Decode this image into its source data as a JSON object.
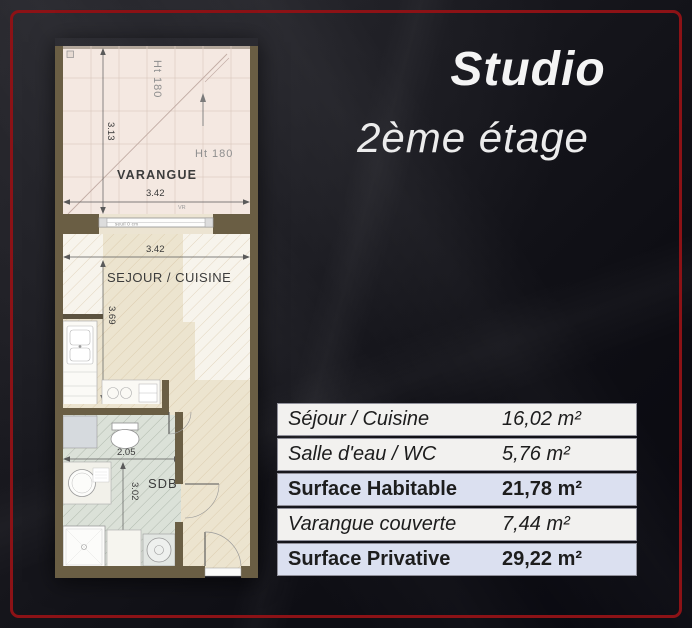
{
  "theme": {
    "frame_color": "#8c1216",
    "background_dark": "#0b0b10",
    "accent_row_color": "#dbe0f0",
    "wall_color": "#6a5e44"
  },
  "header": {
    "title": "Studio",
    "subtitle": "2ème étage"
  },
  "floor_plan": {
    "rooms": {
      "varangue": "VARANGUE",
      "sejour": "SEJOUR / CUISINE",
      "sdb": "SDB"
    },
    "dimensions": {
      "varangue_depth": "3.13",
      "varangue_width": "3.42",
      "sejour_width": "3.42",
      "sejour_depth": "3.69",
      "sdb_width": "2.05",
      "sdb_depth": "3.02"
    },
    "annotations": {
      "height_top": "Ht 180",
      "height_right": "Ht 180",
      "threshold": "seuil 0 cm",
      "shutter": "VR"
    }
  },
  "surface_table": {
    "rows": [
      {
        "label": "Séjour / Cuisine",
        "value": "16,02 m²"
      },
      {
        "label": "Salle d'eau / WC",
        "value": "5,76 m²"
      },
      {
        "label": "Surface Habitable",
        "value": "21,78 m²"
      },
      {
        "label": "Varangue couverte",
        "value": "7,44 m²"
      },
      {
        "label": "Surface Privative",
        "value": "29,22 m²"
      }
    ]
  }
}
